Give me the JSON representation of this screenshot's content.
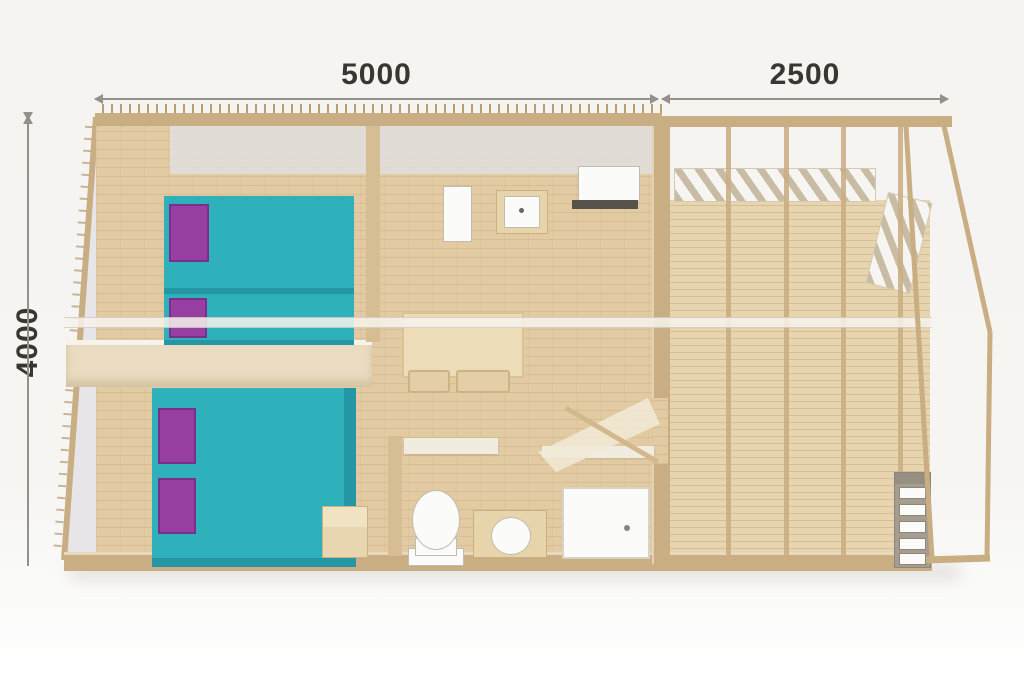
{
  "image_type": "glamping-tent-floor-plan",
  "labels": {
    "top_left": "5000",
    "top_right": "2500",
    "left": "4000"
  },
  "dimensions_mm": {
    "main_width": "5000",
    "deck_width": "2500",
    "depth": "4000"
  },
  "colors": {
    "dim_text": "#3a3733",
    "dim_line": "#94908a",
    "wood_frame": "#c9ad83",
    "wood_wall_light": "#e9dcc0",
    "wall_white": "#f1ece0",
    "floor_wood": "#e2cba3",
    "deck_wood": "#e7d5af",
    "canvas_gray": "#e7e5e8",
    "canvas_top": "#e2e0e3",
    "bed_teal": "#2fb1bb",
    "bed_teal_dark": "#2596a3",
    "pillow_purple": "#963ea2",
    "pillow_border": "#7c2f8a",
    "fixture_white": "#fbfbf9",
    "fixture_border": "#c2bcae",
    "counter_dark": "#57524a",
    "vanity_wood": "#e7d4ab",
    "table_wood": "#ecdcb8",
    "chair_wood": "#e2cfa8",
    "step_wood": "#e8d6b0",
    "beam_white": "#f7f4ee",
    "slat_dark": "#c9bca4",
    "slat_light": "#f7f5f1"
  },
  "features": {
    "bedroom_top": [
      "single-bed-icon",
      "single-bed-icon"
    ],
    "bedroom_bottom": [
      "double-bed-icon",
      "bedside-step-icon"
    ],
    "kitchen": [
      "fridge-icon",
      "sink-icon",
      "counter-icon"
    ],
    "living": [
      "dining-table-icon",
      "chair-icon",
      "chair-icon",
      "rug-icon"
    ],
    "bathroom": [
      "toilet-icon",
      "washbasin-icon",
      "shower-icon"
    ],
    "deck": [
      "decking-icon",
      "pergola-slats-icon",
      "louver-icon",
      "ladder-icon",
      "frame-brace-icon"
    ]
  }
}
